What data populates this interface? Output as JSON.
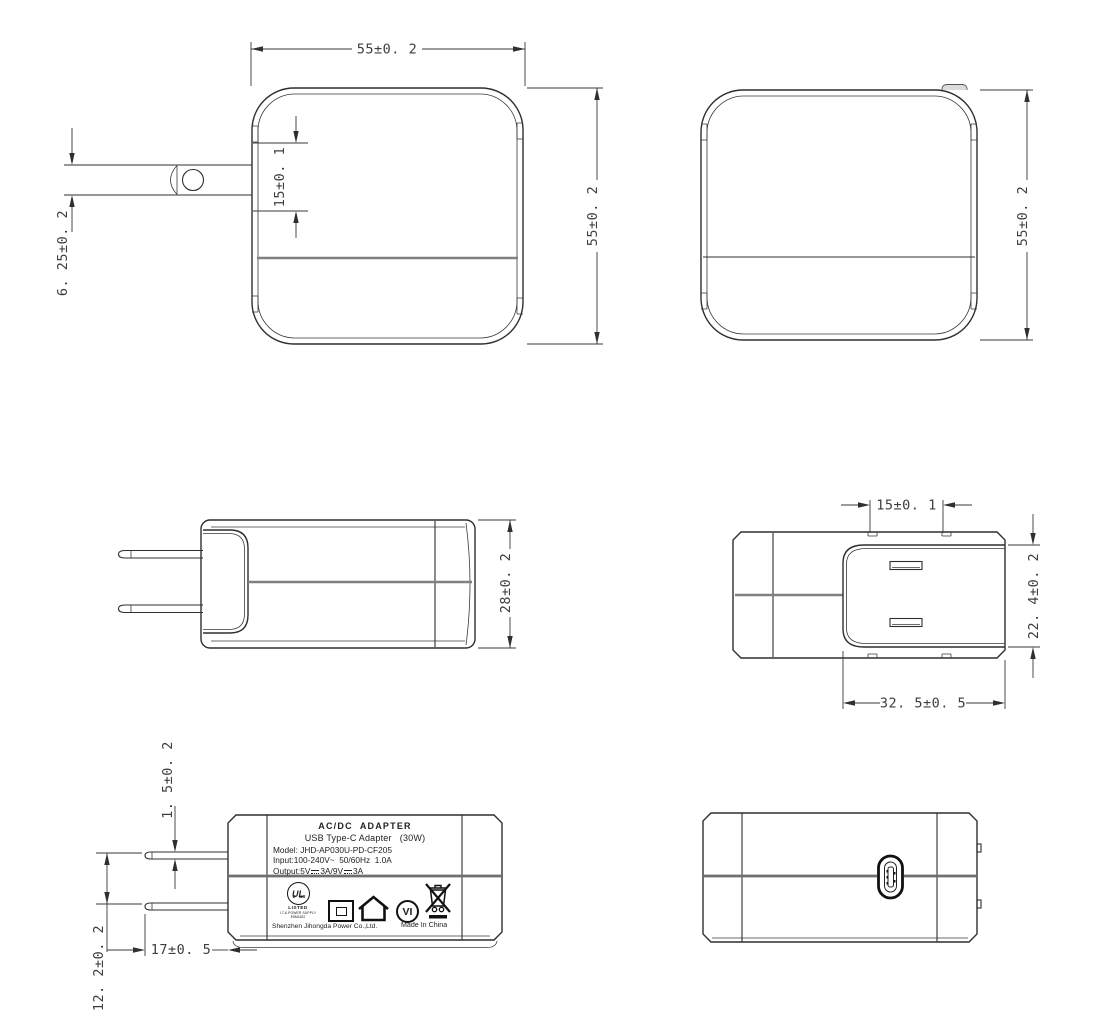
{
  "drawing": {
    "product": "USB Type-C power adapter engineering drawing, six orthographic views"
  },
  "dimensions": {
    "front_width": "55±0. 2",
    "front_height": "55±0. 2",
    "front_slot": "15±0. 1",
    "front_blade": "6. 25±0. 2",
    "rear_height": "55±0. 2",
    "side_height": "28±0. 2",
    "top_slot": "15±0. 1",
    "top_depth": "22. 4±0. 2",
    "top_width": "32. 5±0. 5",
    "blade_thickness": "1. 5±0. 2",
    "blade_gap": "12. 2±0. 2",
    "blade_length": "17±0. 5"
  },
  "label": {
    "title": "AC/DC  ADAPTER",
    "type_line": "USB Type-C Adapter   (30W)",
    "model_line": "Model: JHD-AP030U-PD-CF205",
    "input_line": "Input:100-240V~  50/60Hz  1.0A",
    "output_prefix": "Output:5V",
    "output_mid": "3A/9V",
    "output_suffix": "3A",
    "ul_letters": "UL",
    "ul_c": "c",
    "ul_us": "us",
    "ul_listed": "LISTED",
    "ul_category": "I.T.& POWER SUPPLY",
    "ul_file": "E5M1822",
    "efficiency_mark": "VI",
    "company": "Shenzhen Jihongda Power Co.,Ltd.",
    "origin": "Made In China"
  },
  "colors": {
    "line": "#2f2f2f",
    "seam_gray": "#808080",
    "background": "#ffffff"
  }
}
